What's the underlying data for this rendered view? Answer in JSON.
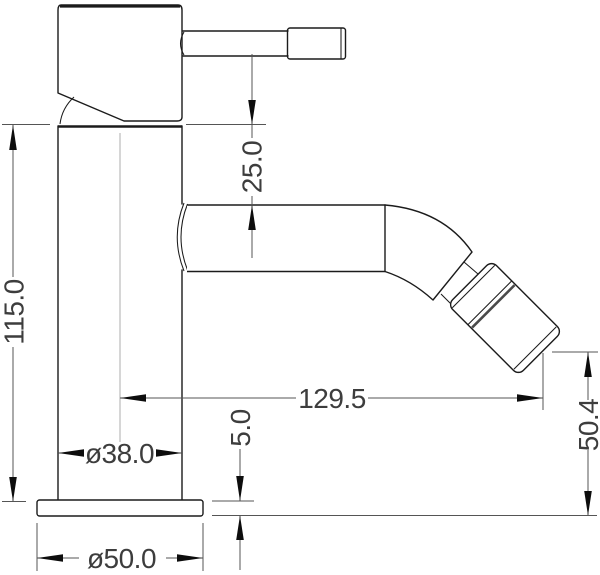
{
  "page": {
    "background": "#ffffff"
  },
  "drawing": {
    "type": "technical_dimension_drawing",
    "view": "side elevation of single-lever mixer tap",
    "line_color": "#1b1b1b",
    "dimension_line_color": "#555555",
    "text_color": "#3d3d3d",
    "dimensions": {
      "overall_height": {
        "label": "115.0",
        "value": 115.0
      },
      "spout_top_offset": {
        "label": "25.0",
        "value": 25.0
      },
      "spout_reach": {
        "label": "129.5",
        "value": 129.5
      },
      "outlet_height": {
        "label": "50.4",
        "value": 50.4
      },
      "body_diameter": {
        "label": "ø38.0",
        "value": 38.0
      },
      "base_plate_thickness": {
        "label": "5.0",
        "value": 5.0
      },
      "base_diameter": {
        "label": "ø50.0",
        "value": 50.0
      }
    }
  }
}
